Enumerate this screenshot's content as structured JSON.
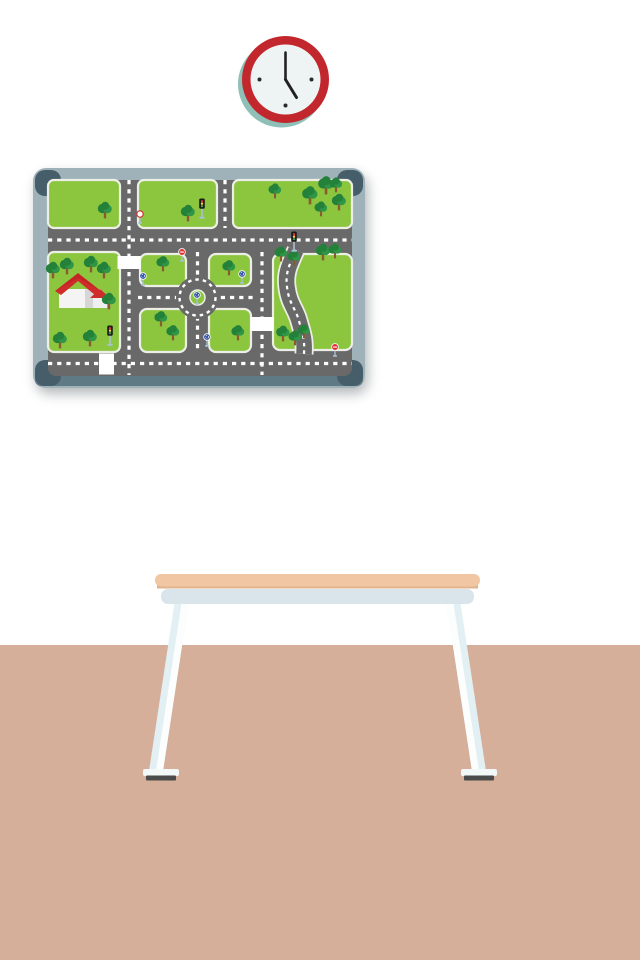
{
  "scene": {
    "description": "Classroom wall with clock, framed traffic-city play map board, and a table on a tan floor",
    "wall_color": "#ffffff",
    "floor_color": "#d5af9a",
    "clock": {
      "time": "5:00",
      "ring_color": "#c2272d",
      "face_color": "#eef4f3",
      "hand_color": "#222222",
      "tick_color": "#2b2b2b",
      "shadow_color": "#8fc0b8"
    },
    "board": {
      "frame_color": "#9fb2ba",
      "corner_color": "#455e69",
      "frame_bottom_color": "#5f7a85",
      "map": {
        "grass_color": "#8cc63f",
        "road_color": "#696969",
        "curb_color": "#edefe6",
        "lane_marking_color": "#ffffff",
        "features": [
          "roundabout",
          "s-curve-road",
          "house",
          "crosswalks",
          "grid-of-streets"
        ],
        "counts": {
          "trees": 24,
          "traffic_lights": 3,
          "roundabout_signs": 4,
          "stop_signs": 2,
          "no_entry_signs": 1,
          "crosswalks": 3,
          "houses": 1
        }
      }
    },
    "table": {
      "top_color": "#f0c7a2",
      "top_edge_color": "#e2b38f",
      "apron_color": "#d9e5ea",
      "leg_color": "#fcfefe",
      "leg_shade_color": "#e2eff3",
      "foot_color": "#4b4b4b"
    }
  }
}
